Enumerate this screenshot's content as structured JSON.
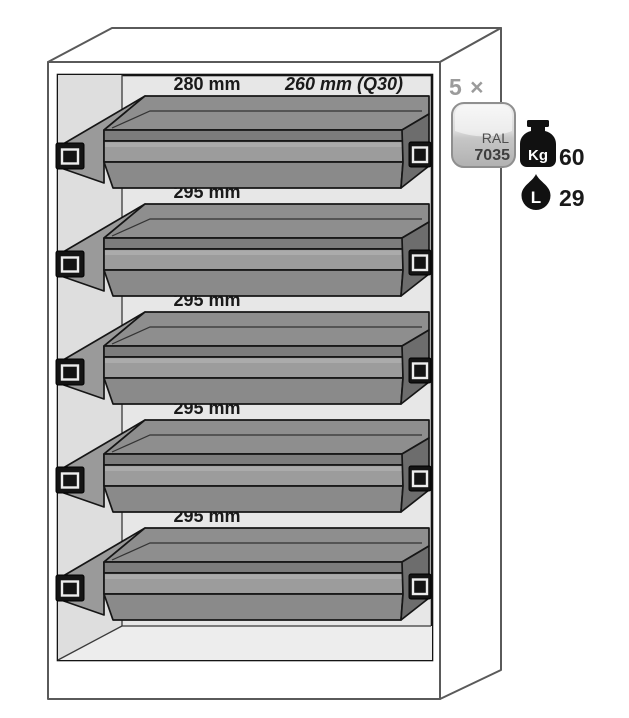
{
  "figure": {
    "description": "Safety cabinet cutaway illustration with five pull-out tray shelves",
    "unit_count_label": "5 ×",
    "trays": [
      {
        "name": "tray-1",
        "width_label": "280 mm",
        "depth_label": "260 mm (Q30)"
      },
      {
        "name": "tray-2",
        "width_label": "295 mm"
      },
      {
        "name": "tray-3",
        "width_label": "295 mm"
      },
      {
        "name": "tray-4",
        "width_label": "295 mm"
      },
      {
        "name": "tray-5",
        "width_label": "295 mm"
      }
    ],
    "ral_badge": {
      "line1": "RAL",
      "line2": "7035"
    },
    "capacity": {
      "icon": "weight-kg-icon",
      "unit_text": "Kg",
      "value": "60"
    },
    "volume": {
      "icon": "liter-drop-icon",
      "unit_text": "L",
      "value": "29"
    },
    "colors": {
      "tray_gray": "#8e8e8e",
      "tray_dark_end": "#6d6d6d",
      "interior_gray": "#e7e7e7",
      "interior_wall_gray": "#dedede",
      "badge_gray": "#c9c9c9",
      "outline": "#161616",
      "cabinet_outline": "#5a5a5a",
      "label_text": "#1a1a1a",
      "muted_text": "#9b9b9b"
    }
  }
}
